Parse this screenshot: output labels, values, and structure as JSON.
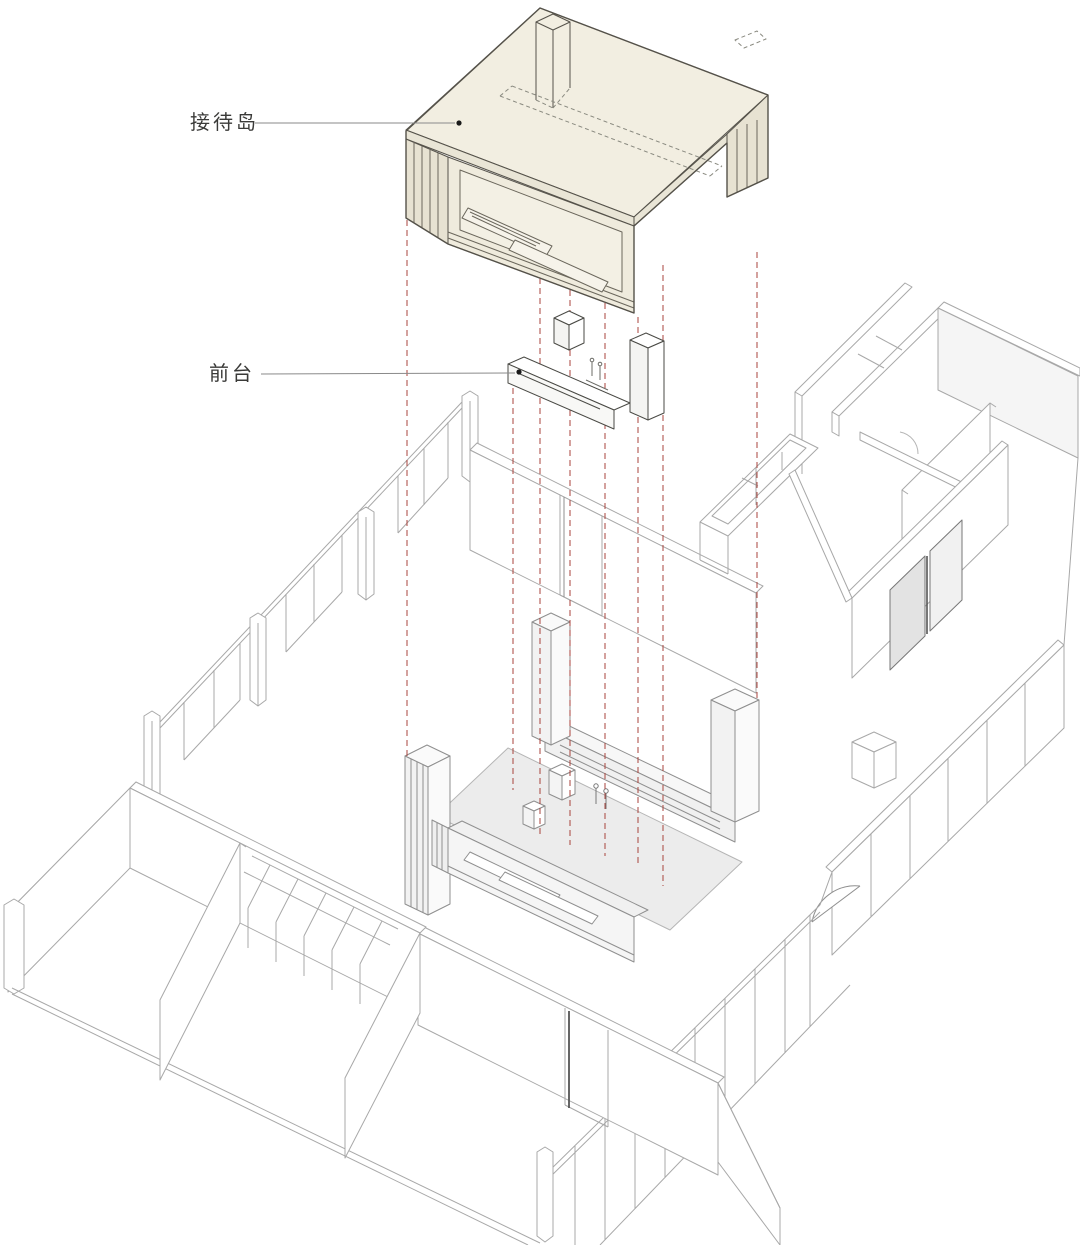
{
  "diagram": {
    "type": "exploded-axonometric-interior",
    "annotations": [
      {
        "id": "reception-island",
        "label": "接待岛"
      },
      {
        "id": "front-desk",
        "label": "前台"
      }
    ],
    "colors": {
      "background": "#ffffff",
      "island_fill": "#f2eee1",
      "island_side_fill": "#e7e2d2",
      "island_line": "#55524a",
      "hidden_line": "#8a8a80",
      "plan_line": "#a8a8a8",
      "assembly_fill": "#ececec",
      "assembly_line": "#8f8f8f",
      "projection_line": "#a8433c",
      "label_text": "#3a3a38",
      "leader_line": "#8a8a8a",
      "leader_dot": "#1a1a1a"
    }
  }
}
